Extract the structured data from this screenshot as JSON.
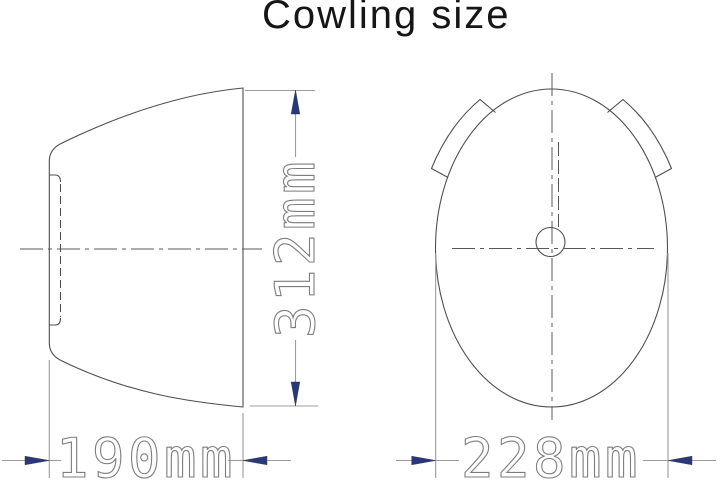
{
  "title": "Cowling size",
  "drawing": {
    "type": "technical-drawing",
    "dimensions": [
      {
        "label": "312mm",
        "value": 312,
        "unit": "mm",
        "orientation": "vertical"
      },
      {
        "label": "190mm",
        "value": 190,
        "unit": "mm",
        "orientation": "horizontal"
      },
      {
        "label": "228mm",
        "value": 228,
        "unit": "mm",
        "orientation": "horizontal"
      }
    ]
  },
  "colors": {
    "background": "#ffffff",
    "outline": "#4f4f4f",
    "centerline": "#585858",
    "dimension_line": "#9c9c9c",
    "dimension_text": "#7d7d7d",
    "arrow": "#283878",
    "title": "#161616"
  }
}
